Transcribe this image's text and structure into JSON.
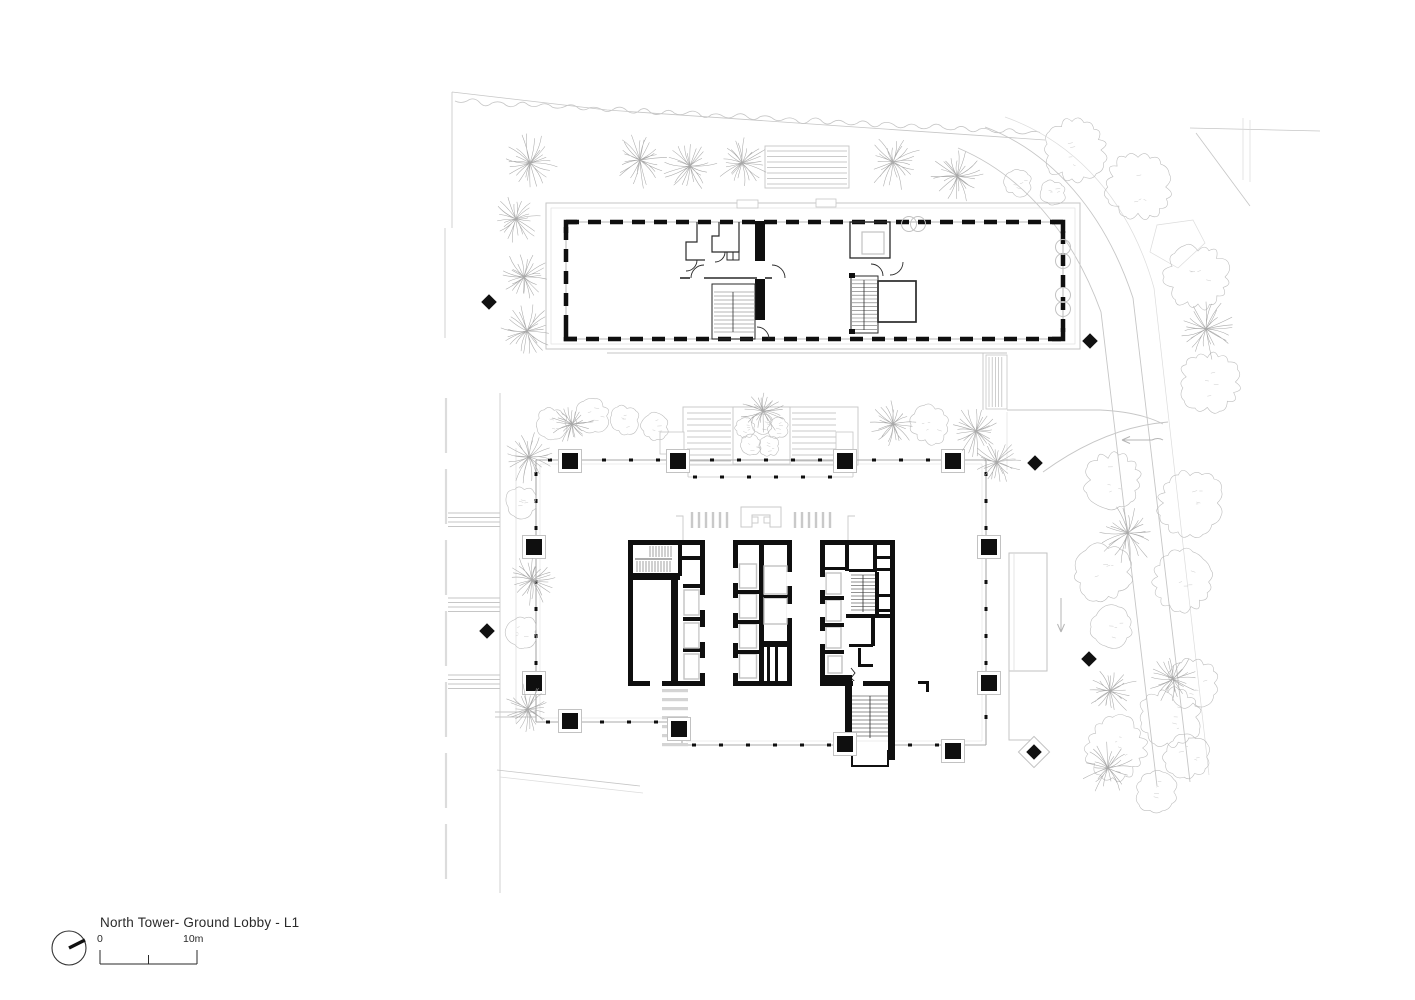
{
  "title_block": {
    "title": "North Tower- Ground Lobby - L1",
    "scale_start": "0",
    "scale_end": "10m"
  },
  "icons": {
    "north_arrow": "north-arrow-icon"
  },
  "palette": {
    "wall_black": "#0f0f0f",
    "ink_thin": "#2a2a2a",
    "line_light": "#c6c6c6",
    "line_lighter": "#dcdcdc",
    "tree_stroke": "#a9a9a9",
    "shrub_stroke": "#bdbdbd",
    "hatch": "#6f6f6f",
    "elevator": "#c2c2c2",
    "background": "#ffffff"
  },
  "plan": {
    "palms": [
      [
        530,
        163,
        30
      ],
      [
        640,
        160,
        28
      ],
      [
        690,
        166,
        26
      ],
      [
        742,
        163,
        27
      ],
      [
        893,
        162,
        28
      ],
      [
        957,
        176,
        26
      ],
      [
        516,
        219,
        24
      ],
      [
        524,
        277,
        26
      ],
      [
        527,
        331,
        26
      ],
      [
        572,
        424,
        22
      ],
      [
        529,
        457,
        26
      ],
      [
        532,
        580,
        25
      ],
      [
        528,
        709,
        25
      ],
      [
        763,
        411,
        22
      ],
      [
        893,
        424,
        23
      ],
      [
        976,
        431,
        26
      ],
      [
        997,
        462,
        23
      ],
      [
        1206,
        329,
        30
      ],
      [
        1128,
        533,
        30
      ],
      [
        1110,
        691,
        27
      ],
      [
        1173,
        679,
        25
      ],
      [
        1108,
        768,
        26
      ]
    ],
    "shrubs": [
      [
        522,
        502,
        15
      ],
      [
        522,
        632,
        15
      ],
      [
        552,
        423,
        15
      ],
      [
        592,
        416,
        17
      ],
      [
        625,
        420,
        14
      ],
      [
        655,
        427,
        13
      ],
      [
        930,
        425,
        19
      ],
      [
        745,
        428,
        10
      ],
      [
        762,
        424,
        10
      ],
      [
        778,
        428,
        10
      ],
      [
        751,
        445,
        10
      ],
      [
        769,
        446,
        10
      ]
    ],
    "trees": [
      [
        1018,
        183,
        13
      ],
      [
        1053,
        193,
        12
      ],
      [
        1075,
        150,
        30
      ],
      [
        1138,
        187,
        32
      ],
      [
        1198,
        277,
        31
      ],
      [
        1210,
        382,
        29
      ],
      [
        1113,
        480,
        27
      ],
      [
        1190,
        503,
        31
      ],
      [
        1103,
        572,
        27
      ],
      [
        1183,
        582,
        29
      ],
      [
        1112,
        627,
        20
      ],
      [
        1170,
        717,
        29
      ],
      [
        1193,
        683,
        24
      ],
      [
        1116,
        748,
        30
      ],
      [
        1187,
        757,
        22
      ],
      [
        1156,
        792,
        20
      ]
    ],
    "diamonds": [
      [
        489,
        302,
        0
      ],
      [
        1090,
        341,
        0
      ],
      [
        1035,
        463,
        0
      ],
      [
        487,
        631,
        0
      ],
      [
        1089,
        659,
        0
      ],
      [
        1034,
        752,
        1
      ]
    ],
    "columns": {
      "top": [
        [
          570,
          461
        ],
        [
          678,
          461
        ],
        [
          845,
          461
        ],
        [
          953,
          461
        ]
      ],
      "bottom": [
        [
          570,
          721
        ],
        [
          679,
          729
        ],
        [
          845,
          744
        ],
        [
          953,
          751
        ]
      ],
      "left": [
        [
          534,
          547
        ],
        [
          534,
          683
        ]
      ],
      "right": [
        [
          989,
          547
        ],
        [
          989,
          683
        ]
      ]
    },
    "podium_circles": [
      [
        909,
        224
      ],
      [
        918,
        224
      ],
      [
        1063,
        247
      ],
      [
        1063,
        261
      ],
      [
        1063,
        295
      ],
      [
        1063,
        309
      ]
    ]
  }
}
